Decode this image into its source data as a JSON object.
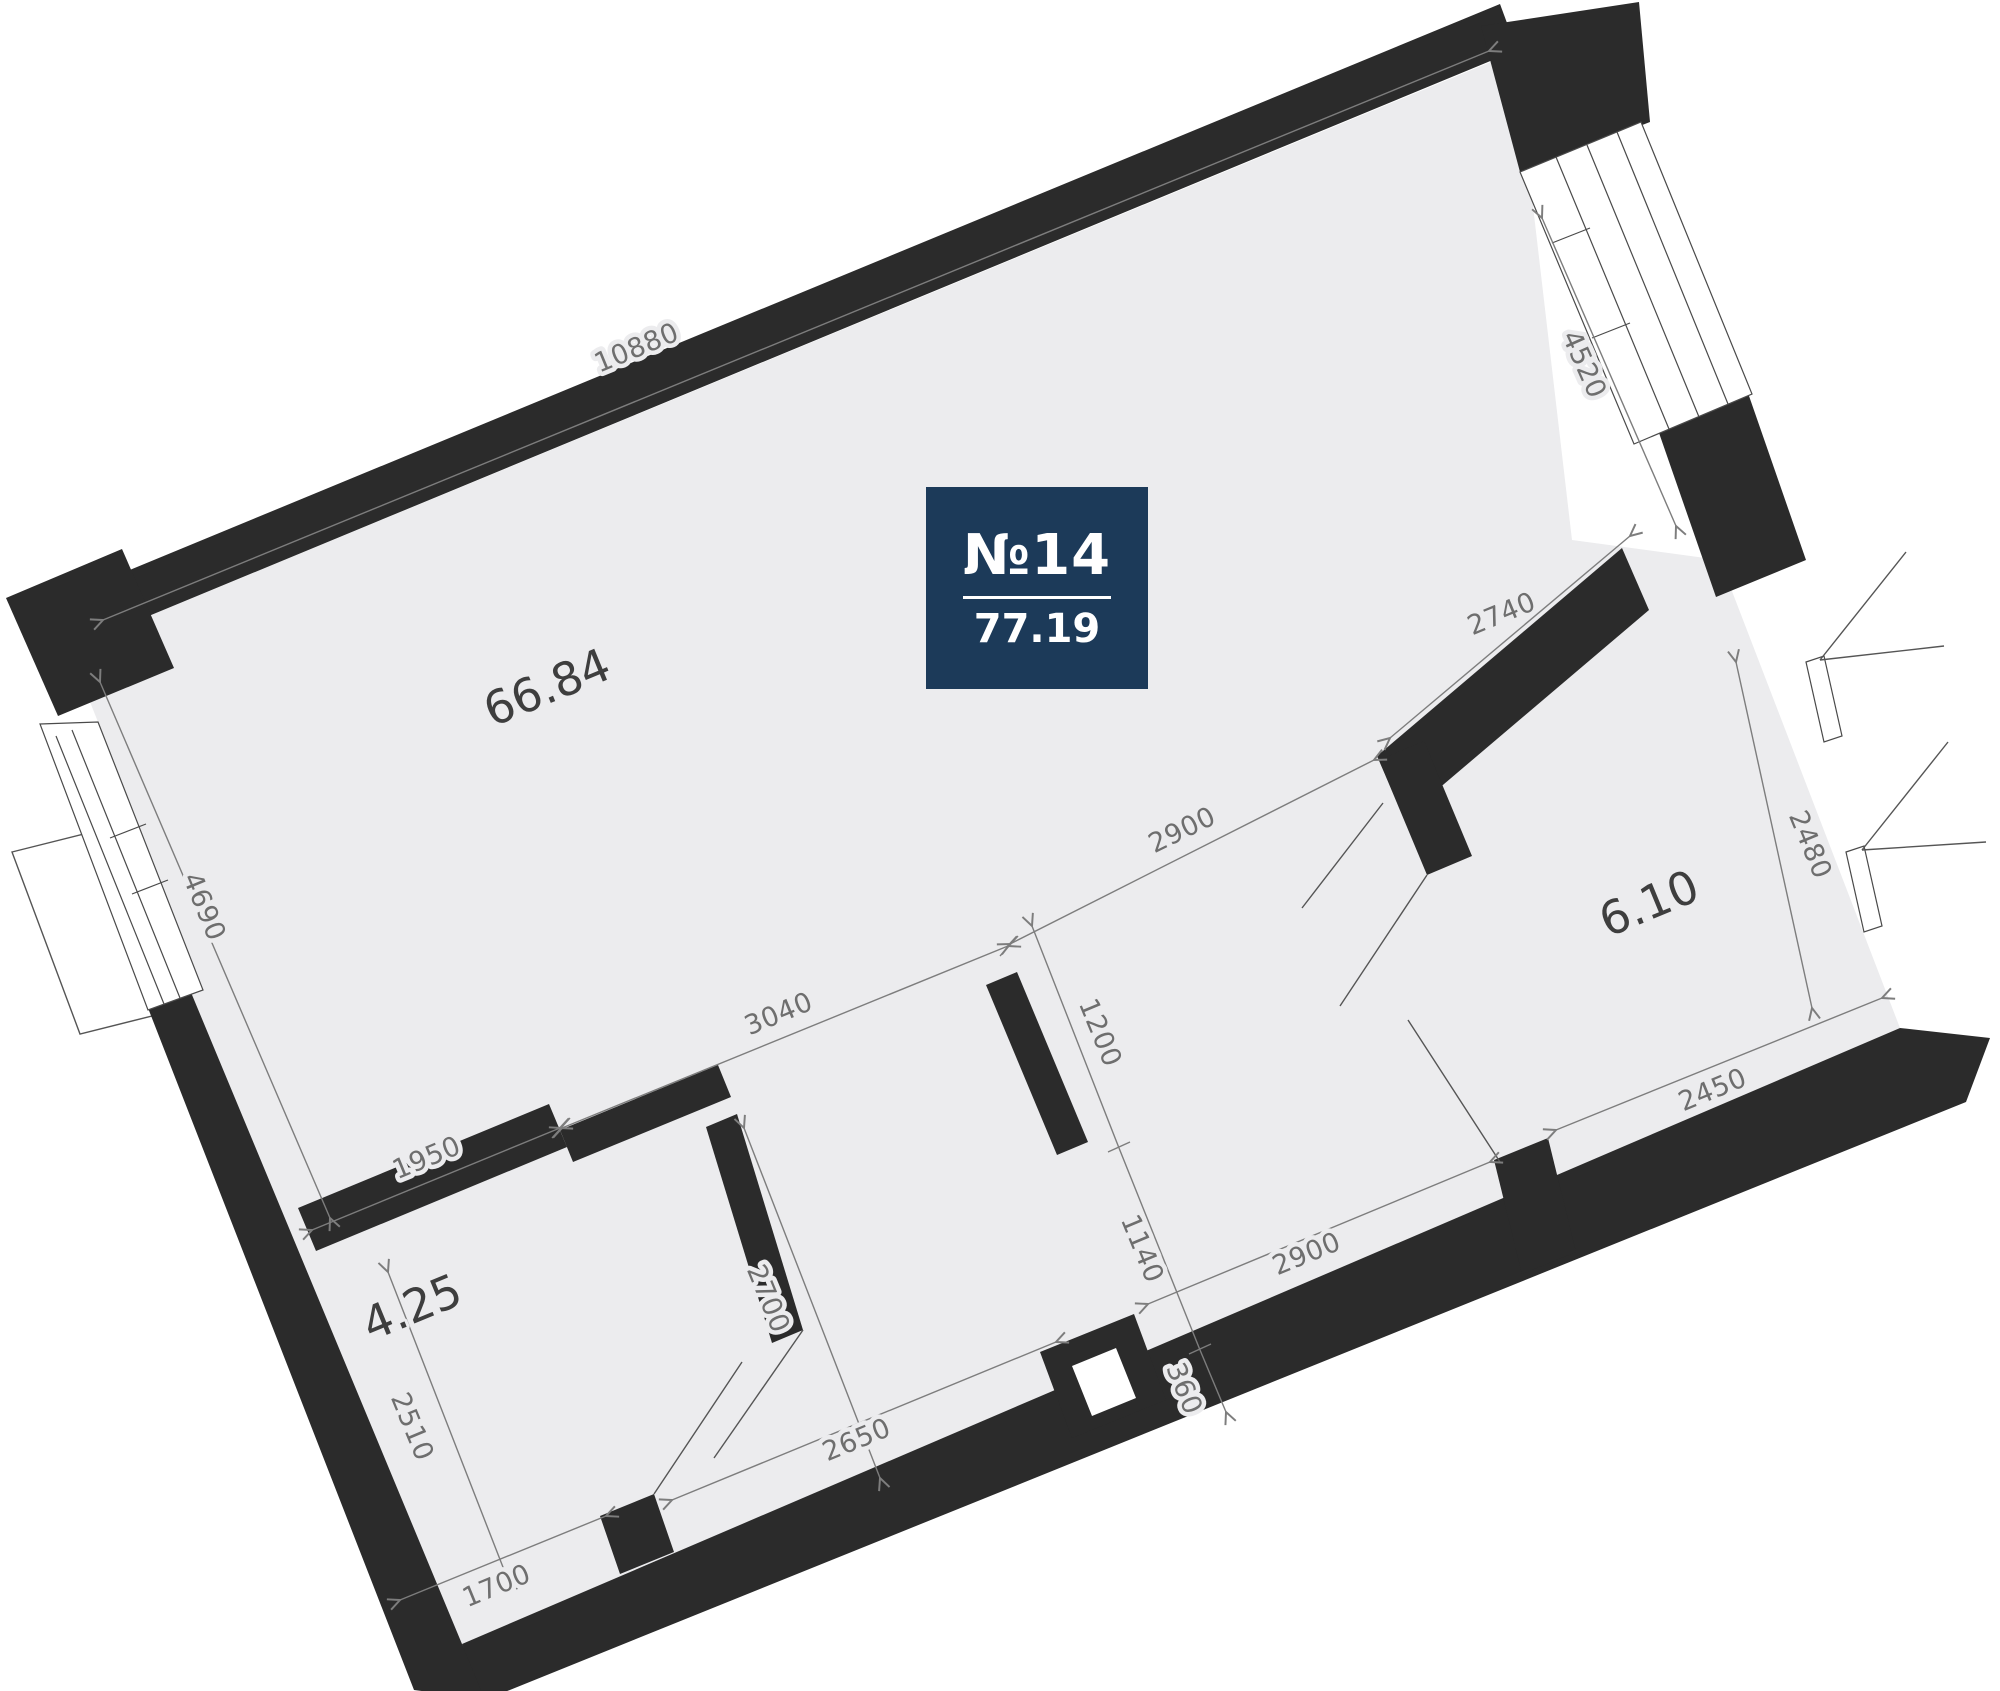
{
  "badge": {
    "number": "№14",
    "area": "77.19"
  },
  "rooms": {
    "living": {
      "area_label": "66.84"
    },
    "bedroom": {
      "area_label": "6.10"
    },
    "storage": {
      "area_label": "4.25"
    }
  },
  "dimensions": {
    "top_wall": "10880",
    "left_height": "4690",
    "right_window": "4520",
    "room_right_top": "2740",
    "open_span_right": "2900",
    "open_span_mid": "3040",
    "open_span_left": "1950",
    "partition_stub": "1200",
    "corridor_gap": "1140",
    "wall_depth": "360",
    "corridor_bottom": "2900",
    "room_right_height": "2480",
    "room_right_bottom": "2450",
    "corridor_height": "2700",
    "storage_height": "2510",
    "storage_width": "1700",
    "corridor_bottom_left": "2650"
  },
  "colors": {
    "wall": "#2b2b2b",
    "floor": "#ececee",
    "badge": "#1c3a59",
    "dimension": "#6e6e6e"
  }
}
